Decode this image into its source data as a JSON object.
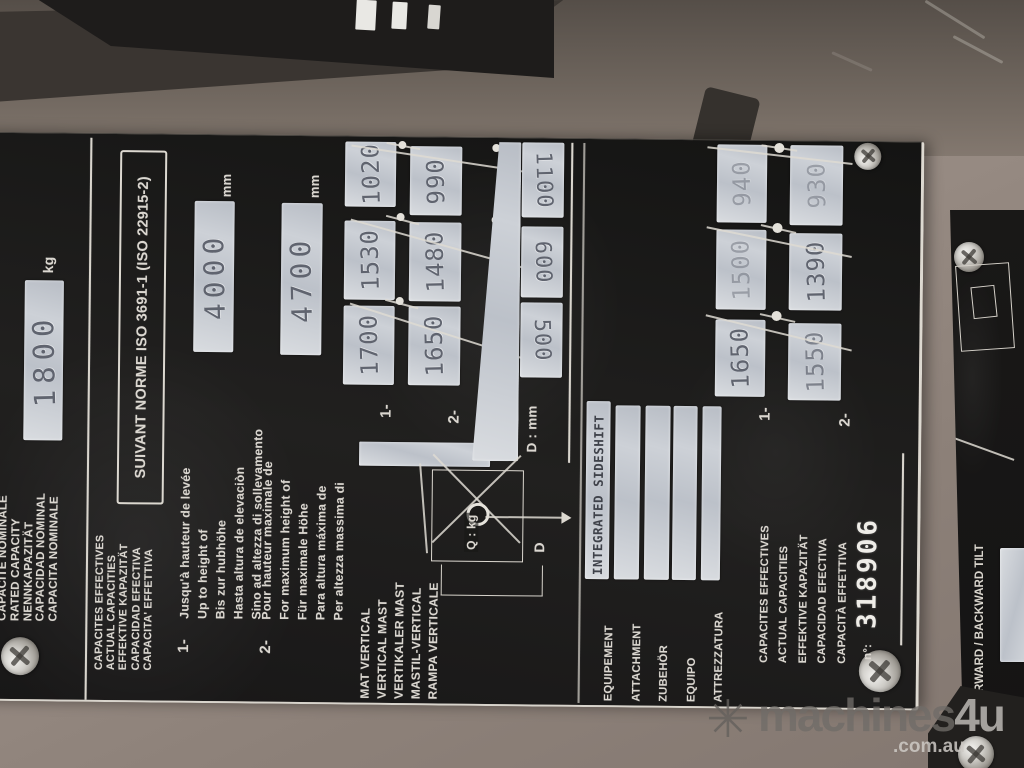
{
  "plate": {
    "rated_capacity": {
      "labels": [
        "CAPACITE NOMINALE",
        "RATED CAPACITY",
        "NENNKAPAZITÄT",
        "CAPACIDAD NOMINAL",
        "CAPACITA NOMINALE"
      ],
      "value": "1800",
      "unit": "kg"
    },
    "standard": "SUIVANT NORME ISO 3691-1 (ISO 22915-2)",
    "actual_capacities_heading": [
      "CAPACITES EFFECTIVES",
      "ACTUAL CAPACITIES",
      "EFFEKTIVE KAPAZITÄT",
      "CAPACIDAD EFECTIVA",
      "CAPACITA' EFFETTIVA"
    ],
    "note1": {
      "index": "1-",
      "lines": [
        "Jusqu'à hauteur de levée",
        "Up to height of",
        "Bis zur hubhöhe",
        "Hasta altura de elevaciòn",
        "Sino ad altezza di sollevamento"
      ],
      "value": "4000",
      "unit": "mm"
    },
    "note2": {
      "index": "2-",
      "lines": [
        "Pour hauteur maximale de",
        "For maximum height of",
        "Für maximale Höhe",
        "Para altura máxima de",
        "Per altezza massima di"
      ],
      "value": "4700",
      "unit": "mm"
    },
    "vertical_mast": {
      "labels": [
        "MAT VERTICAL",
        "VERTICAL MAST",
        "VERTIKALER MAST",
        "MASTIL-VERTICAL",
        "RAMPA VERTICALE"
      ],
      "row1_label": "1-",
      "row1_values": [
        "1700",
        "1530",
        "1020"
      ],
      "row2_label": "2-",
      "row2_values": [
        "1650",
        "1480",
        "990"
      ],
      "d_label": "D : mm",
      "d_values": [
        "500",
        "600",
        "1100"
      ]
    },
    "load_diagram": {
      "q_label": "Q : kg",
      "d_label": "D"
    },
    "equipment": {
      "labels": [
        "EQUIPEMENT",
        "ATTACHMENT",
        "ZUBEHÖR",
        "EQUIPO",
        "ATTREZZATURA"
      ],
      "strip1_text": "INTEGRATED SIDESHIFT"
    },
    "attachment_capacities": {
      "heading": [
        "CAPACITES EFFECTIVES",
        "ACTUAL CAPACITIES",
        "EFFEKTIVE KAPAZITÄT",
        "CAPACIDAD EFECTIVA",
        "CAPACITÀ EFFETTIVA"
      ],
      "row1_label": "1-",
      "row1_values": [
        "1650",
        "1500",
        "940"
      ],
      "row2_label": "2-",
      "row2_values": [
        "1550",
        "1390",
        "930"
      ]
    },
    "serial": {
      "label": "n°:",
      "value": "318906"
    }
  },
  "tilt_plate": {
    "label": "FORWARD / BACKWARD TILT"
  },
  "watermark": {
    "icon_glyph": "✳",
    "brand": "machines",
    "brand_suffix": "4u",
    "domain": ".com.au"
  },
  "colors": {
    "plate_black": "#1a1918",
    "stamp_silver": "#c8ccd3",
    "engraved_white": "#dbd7d0",
    "body_beige": "#998d85"
  }
}
